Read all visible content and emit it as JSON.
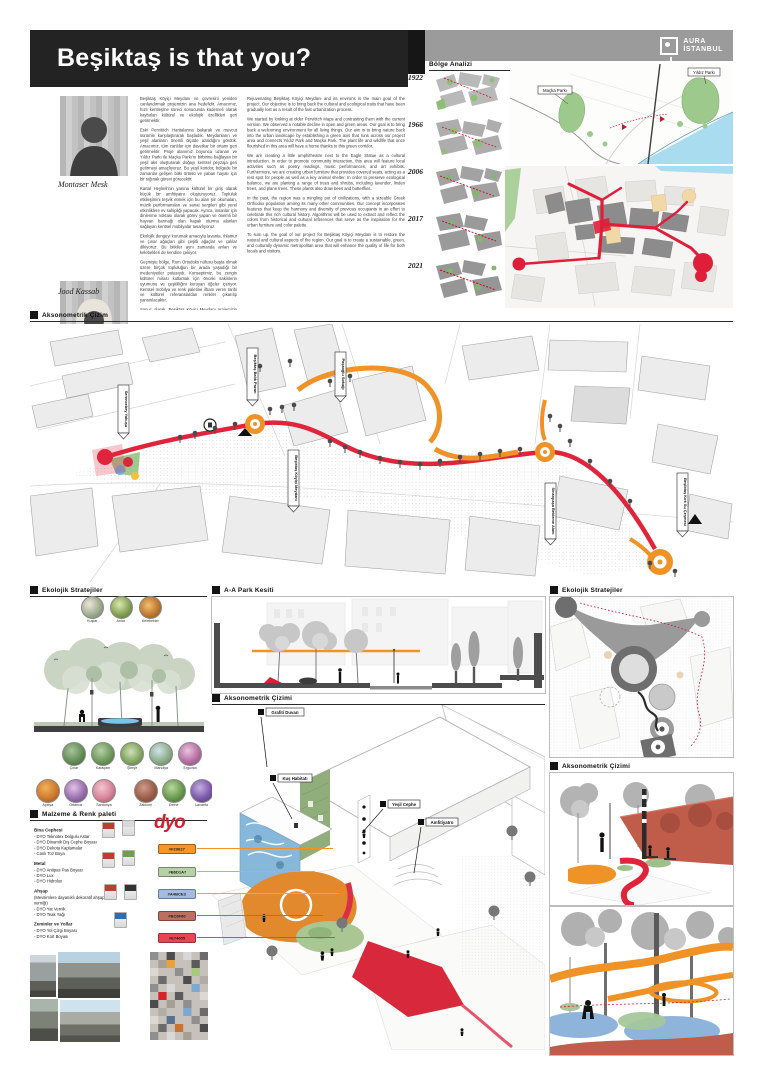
{
  "header": {
    "title": "Beşiktaş is that you?",
    "logo_line1": "AURA",
    "logo_line2": "İSTANBUL"
  },
  "team": {
    "member1": "Montaser Mesk",
    "member2": "Jood Kassab"
  },
  "intro_tr": {
    "p1": "Beşiktaş Köyiçi Meydanı ve çevresini yeniden canlandırmak projemizin ana hedefidir. Amacımız, hızlı kentleşme süreci sonucunda kademeli olarak kaybolan kültürel ve ekolojik özellikleri geri getirmektir.",
    "p2": "Eski Pervititch Haritalarına bakarak ve mevcut sürümle karşılaştırarak başladık. Meydanların ve yeşil alanların önemli ölçüde azaldığını gördük. Amacımız, tüm canlılar için davetkar bir ortamı geri getirmektir. Proje alanımız boyunca uzanan ve Yıldız Parkı ile Maçka Parkı'nı birbirine bağlayan bir yeşil aks oluşturarak doğayı kentsel peyzaja geri getirmeyi amaçlıyoruz. Bu yeşil koridor, bölgede bir zamanlar gelişen bitki örtüsü ve yaban hayatı için bir sığınak görevi görecektir.",
    "p3": "Kartal Heykeli'nin yanına kültürel bir giriş olarak küçük bir amfitiyatro oluşturuyoruz. Topluluk etkileşimini teşvik etmek için bu alan şiir okumaları, müzik performansları ve sanat sergileri gibi yerel etkinliklere ev sahipliği yapacak. Ayrıca, insanlar için dinlenme noktası olarak görev yapan ve önemli bir hayvan barınağı olan kapalı oturma alanları sağlayan kentsel mobilyalar tasarlıyoruz.",
    "p4": "Ekolojik dengeyi korumak amacıyla lavanta, ıhlamur ve çınar ağaçları gibi çeşitli ağaçlar ve çalılar dikiyoruz. Bu bitkiler aynı zamanda arıları ve kelebekleri de kendine çekiyor.",
    "p5": "Geçmişte bölge, Rum Ortodoks nüfusu başta olmak üzere birçok topluluğun bir arada yaşadığı bir medeniyetler potasıydı. Konseptimiz, bu zengin kültürel mirası kutlamak için önceki sakinlerin uyumunu ve çeşitliliğini koruyan öğeler içeriyor. Kentsel mobilya ve renk paletine ilham veren tarihi ve kültürel referanslardan renkler çıkarılıp yansıtılacaktır.",
    "p6": "Sonuç olarak, Beşiktaş Köyiçi Meydanı projemizin amacı, bölgenin doğal ve kültürel yönlerini yeniden canlandırmaktır. Amacımız hem yerel halkın hem de ziyaretçilerin yaşam kalitesini artıracak sürdürülebilir, yeşil ve kültürel açıdan dinamik bir kentsel alan yaratmaktır."
  },
  "intro_en": {
    "p1": "Rejuvenating Beşiktaş Köyiçi Meydanı and its environs is the main goal of the project. Our objective is to bring back the cultural and ecological traits that have been gradually lost as a result of the fast urbanization process.",
    "p2": "We started by looking at older Pervititch Maps and contrasting them with the current version. We observed a notable decline in open and green areas. Our goal is to bring back a welcoming environment for all living things. Our aim is to bring nature back into the urban landscape by establishing a green axis that runs across our project area and connects Yıldız Park and Maçka Park. The plant life and wildlife that once flourished in this area will have a home thanks to this green corridor.",
    "p3": "We are creating a little amphitheatre next to the Eagle Statue as a cultural introduction. In order to promote community interaction, this area will feature local activities such as poetry readings, music performances, and art exhibits. Furthermore, we are creating urban furniture that provides covered seats, acting as a rest spot for people as well as a key animal shelter. In order to preserve ecological balance, we are planting a range of trees and shrubs, including lavender, linden trees, and plane trees. These plants also draw bees and butterflies.",
    "p4": "In the past, the region was a mingling pot of civilizations, with a sizeable Greek Orthodox population among its many other communities. Our concept incorporates features that keep the harmony and diversity of previous occupants in an effort to celebrate this rich cultural history. Algorithms will be used to extract and reflect the colors from historical and cultural references that serve as the inspiration for the urban furniture and color palette.",
    "p5": "To sum up, the goal of our project for Beşiktaş Köyiçi Meydanı is to restore the natural and cultural aspects of the region. Our goal is to create a sustainable, green, and culturally dynamic metropolitan area that will enhance the quality of life for both locals and visitors."
  },
  "region": {
    "header": "Bölge Analizi",
    "year1": "1922",
    "year2": "1966",
    "year3": "2006",
    "year4": "2017",
    "year5": "2021",
    "park1": "Maçka Parkı",
    "park2": "Yıldız Parkı"
  },
  "plan": {
    "header": "Aksonometrik Çizim",
    "label1": "Serencebey Yokuşu",
    "label2": "Beşiktaş Balık Pazarı",
    "label3": "Paşaoğlu Sokağı",
    "label4": "Beşiktaş Köyiçi Meydanı",
    "label5": "Sinanpaşa Bekleme Alanı",
    "label6": "Beşiktaş Kırk Su Çeşmesi"
  },
  "ecology": {
    "header": "Ekolojik Stratejiler",
    "fauna1": "Kuşlar",
    "fauna2": "Arılar",
    "fauna3": "Kelebekler",
    "flora1": "Çınar",
    "flora2": "Karaçam",
    "flora3": "Şimşir",
    "flora4": "Manolya",
    "flora5": "Erguvan",
    "flora6": "Açelya",
    "flora7": "Ortanca",
    "flora8": "Sardunya",
    "flora9": "Zakkum",
    "flora10": "Defne",
    "flora11": "Lavanta"
  },
  "section_aa": {
    "header": "A-A Park Kesiti"
  },
  "axon_mid": {
    "header": "Aksonometrik Çizimi",
    "label1": "Grafiti Duvarı",
    "label2": "Kuş Habitatı",
    "label3": "Yeşil Cephe",
    "label4": "Amfitiyatro"
  },
  "ecology_right": {
    "header": "Ekolojik Stratejiler"
  },
  "axon_right": {
    "header": "Aksonometrik Çizimi"
  },
  "materials": {
    "header": "Malzeme & Renk paleti",
    "brand": "dyo",
    "g1_title": "Bina Cephesi",
    "g1_i1": "- DYO Teknotex Dolgulu Astar",
    "g1_i2": "- DYO Dinamik Dış Cephe Boyası",
    "g1_i3": "- DYO Dekota Kaplamalar",
    "g1_i4": "- Canlı Toz Boya",
    "g2_title": "Metal",
    "g2_i1": "- DYO Antipas Pas Boyası",
    "g2_i2": "- DYO Lux",
    "g2_i3": "- DYO Hidrolux",
    "g3_title": "Ahşap",
    "g3_i1": "(Mevsimlere dayanıklı dekoratif ahşap verniği)",
    "g3_i2": "- DYO Yat Vernik",
    "g3_i3": "- DYO Teak Yağı",
    "g4_title": "Zeminler ve Yollar",
    "g4_i1": "- DYO Yol Çizgi Boyası",
    "g4_i2": "- DYO Kort Boyası",
    "sw1": "#F29627",
    "sw2": "#B6D1A7",
    "sw3": "#A4BCE3",
    "sw4": "#BC6F60",
    "sw5": "#E74655"
  },
  "colors": {
    "accent_red": "#E0243C",
    "accent_orange": "#EF9327",
    "park_green": "#9DC98C",
    "water_blue": "#A9DCEF",
    "title_bg": "#232323",
    "bar_gray": "#9B9B9B"
  }
}
